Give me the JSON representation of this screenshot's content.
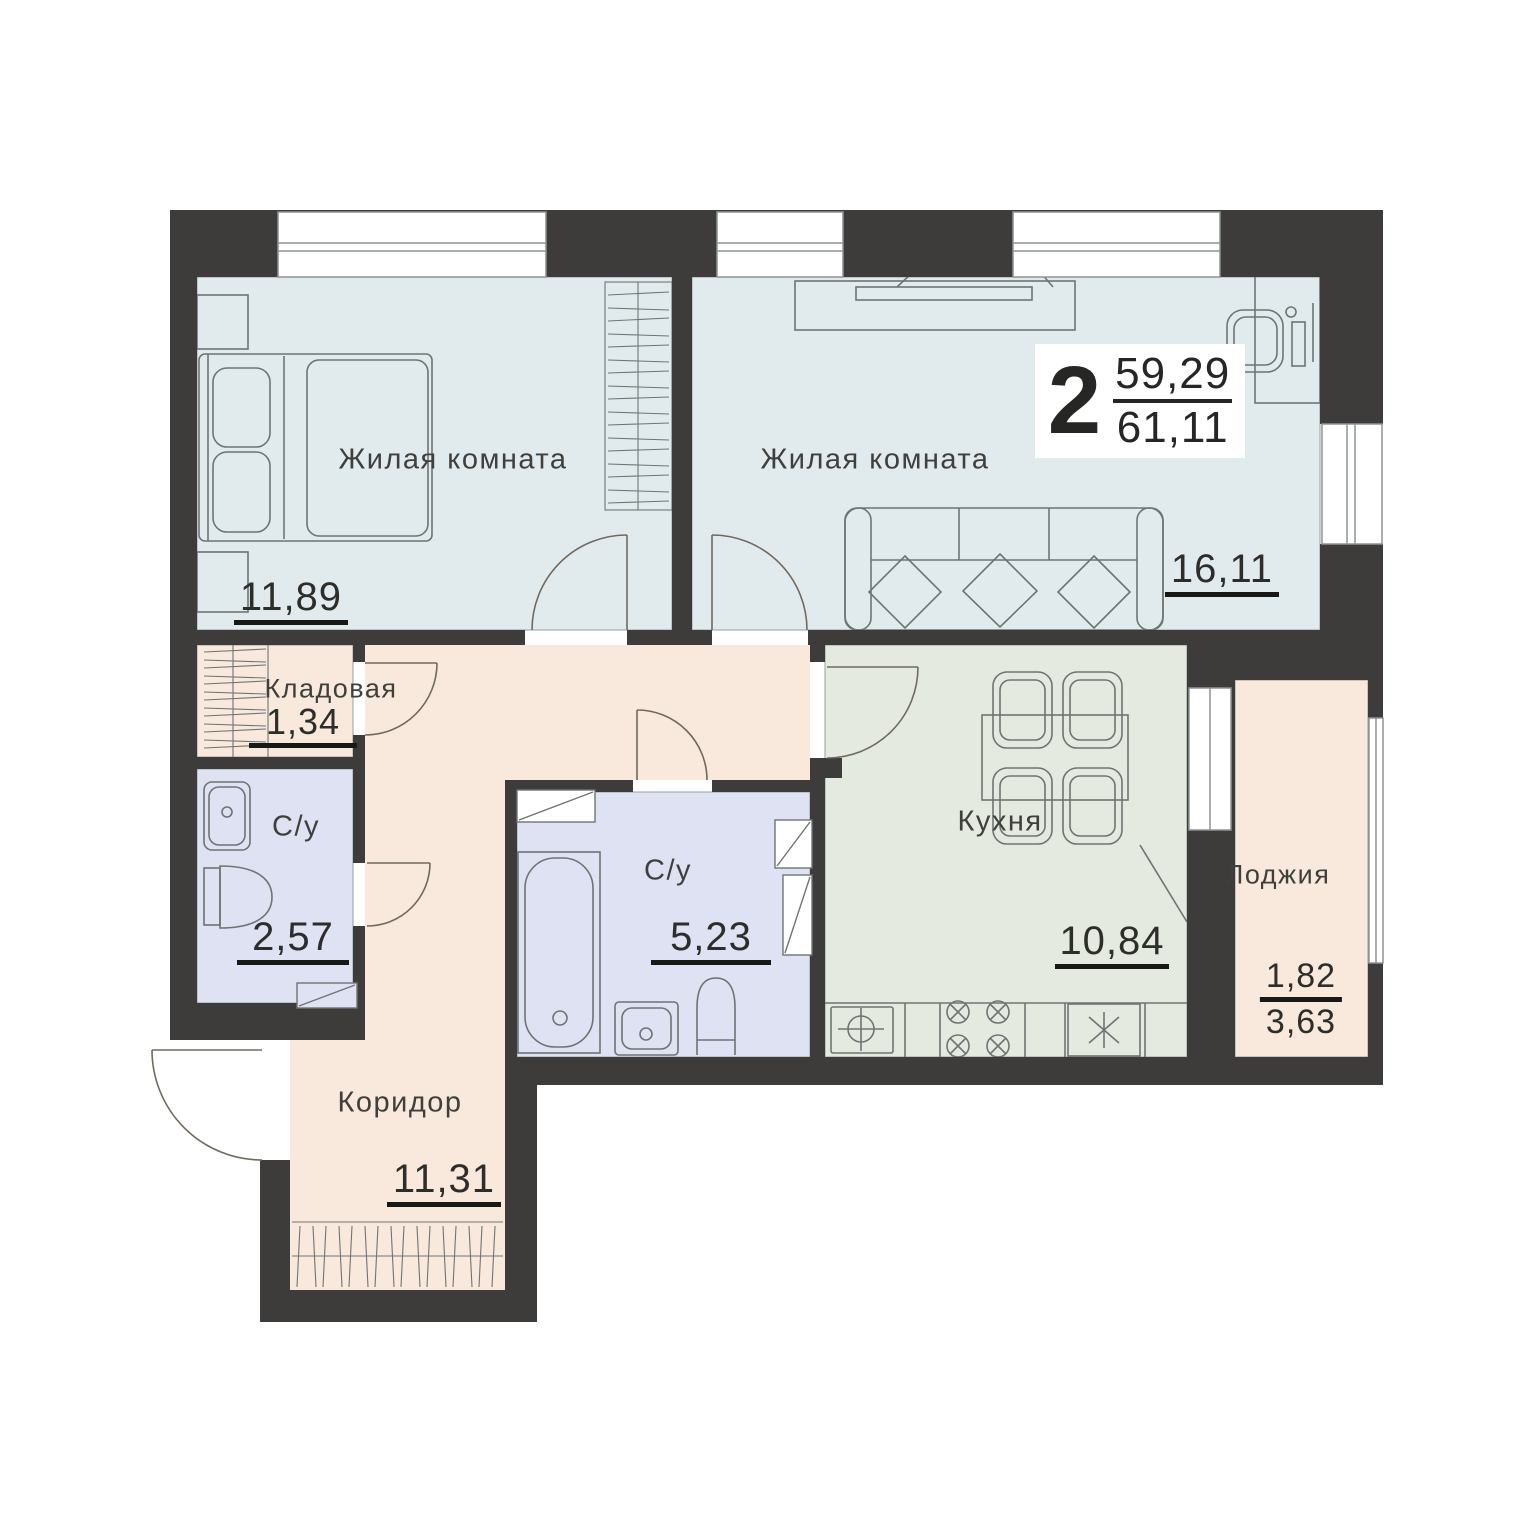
{
  "badge": {
    "rooms_count": "2",
    "living_area": "59,29",
    "total_area": "61,11"
  },
  "rooms": [
    {
      "id": "bedroom",
      "label": "Жилая комната",
      "area": "11,89"
    },
    {
      "id": "living-room",
      "label": "Жилая комната",
      "area": "16,11"
    },
    {
      "id": "storage",
      "label": "Кладовая",
      "area": "1,34"
    },
    {
      "id": "bathroom-small",
      "label": "С/у",
      "area": "2,57"
    },
    {
      "id": "bathroom-main",
      "label": "С/у",
      "area": "5,23"
    },
    {
      "id": "kitchen",
      "label": "Кухня",
      "area": "10,84"
    },
    {
      "id": "corridor",
      "label": "Коридор",
      "area": "11,31"
    },
    {
      "id": "loggia",
      "label": "Лоджия",
      "area_coefficient": "1,82",
      "area_full": "3,63"
    }
  ],
  "colors": {
    "walls": "#3d3c3a",
    "living_rooms_fill": "#e1ebed",
    "kitchen_fill": "#e5eae0",
    "hallway_fill": "#f8e9dc",
    "bathroom_fill": "#dfe2f3",
    "furniture_outline": "#6e7473",
    "text": "#3a3a38"
  }
}
